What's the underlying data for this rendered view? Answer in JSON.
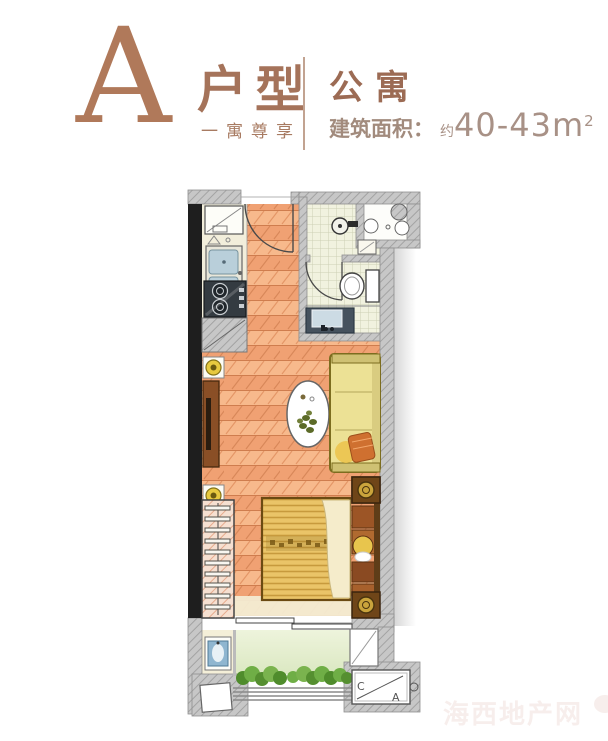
{
  "header": {
    "unit_letter": "A",
    "unit_type_label": "户型",
    "tagline": "一寓尊享",
    "category": "公寓",
    "area": {
      "label": "建筑面积：",
      "approx": "约",
      "value": "40-43m",
      "exponent": "2"
    }
  },
  "plan": {
    "section_marker": {
      "left_letter": "C",
      "right_letter": "A"
    }
  },
  "watermark": {
    "text": "海西地产网"
  },
  "colors": {
    "accent_brown": "#b0795a",
    "category_brown": "#9c6b54",
    "area_text": "#a89186",
    "wall_gray": "#c7c7c7",
    "structural_black": "#1e1e1e",
    "wood_floor": "#f3a878",
    "kitchen_cream": "#f2eedb",
    "tile_cream": "#f1f2df",
    "balcony_green": "#e2ecca",
    "bush_green": "#6fae46",
    "bed_gold": "#eac468",
    "sofa_yellow": "#ece195",
    "furniture_brown": "#8a4f26",
    "basin_blue": "#8fb6d0"
  }
}
